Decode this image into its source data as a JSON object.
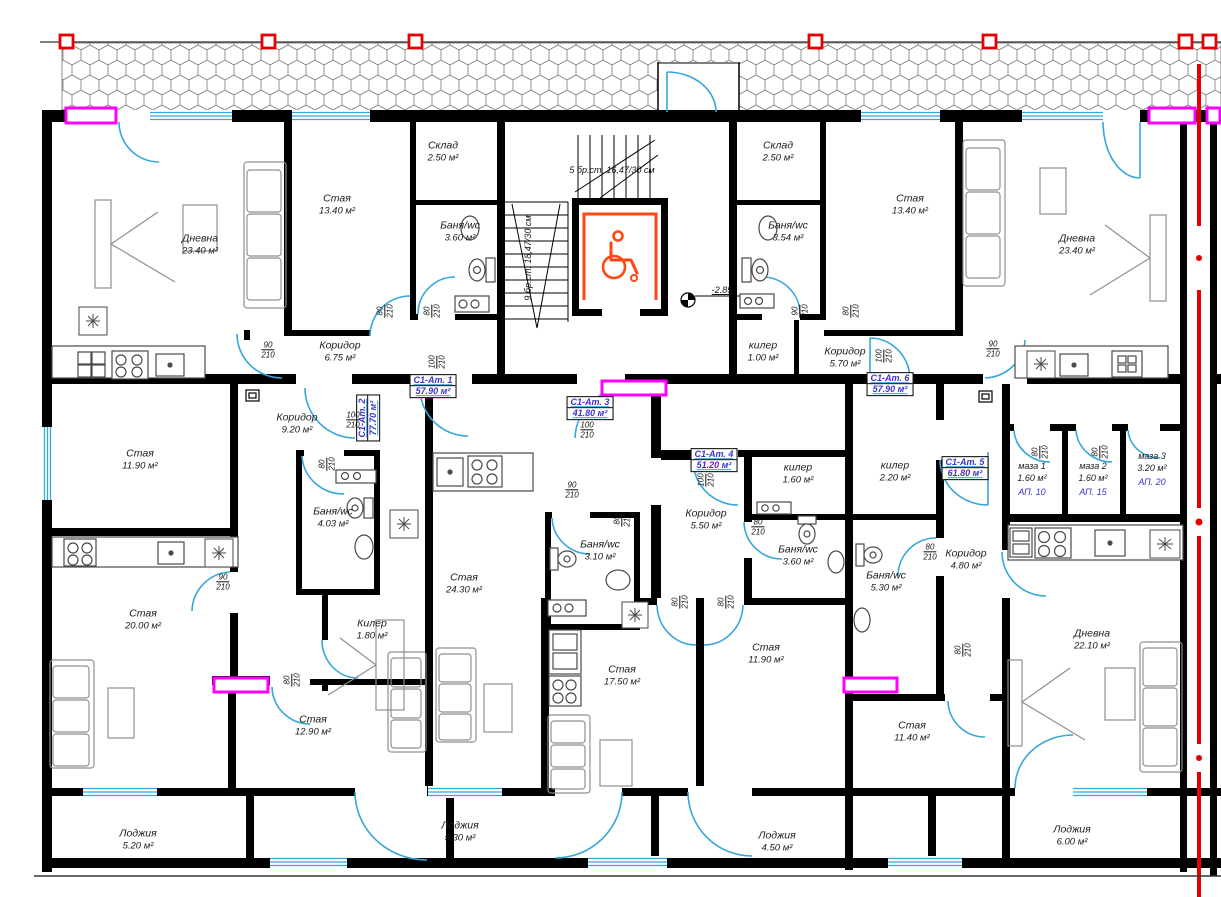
{
  "colors": {
    "wall": "#000000",
    "opening": "#35a7d9",
    "highlight": "#ff00ff",
    "datum": "#e60000",
    "accessible": "#ff4713",
    "apartment_text": "#3a35cc",
    "hatch": "#777777",
    "furniture": "#8f8f8f"
  },
  "rooms": [
    {
      "label": "Дневна",
      "area": "23.40 м²",
      "x": 200,
      "y": 245,
      "vertical": false
    },
    {
      "label": "Стая",
      "area": "13.40 м²",
      "x": 337,
      "y": 205,
      "vertical": false
    },
    {
      "label": "Склад",
      "area": "2.50 м²",
      "x": 443,
      "y": 152,
      "vertical": false
    },
    {
      "label": "Баня/wc",
      "area": "3.60 м²",
      "x": 460,
      "y": 232,
      "vertical": false
    },
    {
      "label": "Коридор",
      "area": "6.75 м²",
      "x": 340,
      "y": 352,
      "vertical": false
    },
    {
      "label": "Склад",
      "area": "2.50 м²",
      "x": 778,
      "y": 152,
      "vertical": false
    },
    {
      "label": "Баня/wc",
      "area": "3.54 м²",
      "x": 788,
      "y": 232,
      "vertical": false
    },
    {
      "label": "Стая",
      "area": "13.40 м²",
      "x": 910,
      "y": 205,
      "vertical": false
    },
    {
      "label": "Дневна",
      "area": "23.40 м²",
      "x": 1077,
      "y": 245,
      "vertical": false
    },
    {
      "label": "килер",
      "area": "1.00 м²",
      "x": 763,
      "y": 352,
      "vertical": false
    },
    {
      "label": "Коридор",
      "area": "5.70 м²",
      "x": 845,
      "y": 358,
      "vertical": false
    },
    {
      "label": "Стая",
      "area": "11.90 м²",
      "x": 140,
      "y": 460,
      "vertical": false
    },
    {
      "label": "Коридор",
      "area": "9.20 м²",
      "x": 297,
      "y": 424,
      "vertical": false
    },
    {
      "label": "Баня/wc",
      "area": "4.03 м²",
      "x": 333,
      "y": 518,
      "vertical": false
    },
    {
      "label": "Стая",
      "area": "20.00 м²",
      "x": 143,
      "y": 620,
      "vertical": false
    },
    {
      "label": "Килер",
      "area": "1.80 м²",
      "x": 372,
      "y": 630,
      "vertical": false
    },
    {
      "label": "Стая",
      "area": "12.90 м²",
      "x": 313,
      "y": 726,
      "vertical": false
    },
    {
      "label": "Лоджия",
      "area": "5.20 м²",
      "x": 138,
      "y": 840,
      "vertical": false
    },
    {
      "label": "Стая",
      "area": "24.30 м²",
      "x": 464,
      "y": 584,
      "vertical": false
    },
    {
      "label": "Баня/wc",
      "area": "3.10 м²",
      "x": 600,
      "y": 551,
      "vertical": false
    },
    {
      "label": "Стая",
      "area": "17.50 м²",
      "x": 622,
      "y": 676,
      "vertical": false
    },
    {
      "label": "Лоджия",
      "area": "5.30 м²",
      "x": 460,
      "y": 832,
      "vertical": false
    },
    {
      "label": "Коридор",
      "area": "5.50 м²",
      "x": 706,
      "y": 520,
      "vertical": false
    },
    {
      "label": "килер",
      "area": "1.60 м²",
      "x": 798,
      "y": 474,
      "vertical": false
    },
    {
      "label": "Баня/wc",
      "area": "3.60 м²",
      "x": 798,
      "y": 556,
      "vertical": false
    },
    {
      "label": "Стая",
      "area": "11.90 м²",
      "x": 766,
      "y": 654,
      "vertical": false
    },
    {
      "label": "Лоджия",
      "area": "4.50 м²",
      "x": 777,
      "y": 842,
      "vertical": false
    },
    {
      "label": "килер",
      "area": "2.20 м²",
      "x": 895,
      "y": 472,
      "vertical": false
    },
    {
      "label": "Баня/wc",
      "area": "5.30 м²",
      "x": 886,
      "y": 582,
      "vertical": false
    },
    {
      "label": "Коридор",
      "area": "4.80 м²",
      "x": 966,
      "y": 560,
      "vertical": false
    },
    {
      "label": "Стая",
      "area": "11.40 м²",
      "x": 912,
      "y": 732,
      "vertical": false
    },
    {
      "label": "Дневна",
      "area": "22.10 м²",
      "x": 1092,
      "y": 640,
      "vertical": false
    },
    {
      "label": "Лоджия",
      "area": "6.00 м²",
      "x": 1072,
      "y": 836,
      "vertical": false
    }
  ],
  "apartments": [
    {
      "id": "С1-Ат. 1",
      "area": "57.90 м²",
      "x": 433,
      "y": 386,
      "vertical": false
    },
    {
      "id": "С1-Ат. 2",
      "area": "77.70 м²",
      "x": 368,
      "y": 418,
      "vertical": true
    },
    {
      "id": "С1-Ат. 3",
      "area": "41.80 м²",
      "x": 590,
      "y": 408,
      "vertical": false
    },
    {
      "id": "С1-Ат. 4",
      "area": "51.20 м²",
      "x": 714,
      "y": 460,
      "vertical": false
    },
    {
      "id": "С1-Ат. 5",
      "area": "61.80 м²",
      "x": 965,
      "y": 468,
      "vertical": false
    },
    {
      "id": "С1-Ат. 6",
      "area": "57.90 м²",
      "x": 890,
      "y": 384,
      "vertical": false
    }
  ],
  "cellars": [
    {
      "label": "маза 1",
      "area": "1.60 м²",
      "apt": "АП. 10",
      "x": 1032,
      "y": 480
    },
    {
      "label": "маза 2",
      "area": "1.60 м²",
      "apt": "АП. 15",
      "x": 1093,
      "y": 480
    },
    {
      "label": "маза 3",
      "area": "3.20 м²",
      "apt": "АП. 20",
      "x": 1152,
      "y": 470
    }
  ],
  "door_labels": [
    {
      "size": "90/210",
      "x": 268,
      "y": 350,
      "vertical": false
    },
    {
      "size": "80/210",
      "x": 385,
      "y": 311,
      "vertical": true
    },
    {
      "size": "80/210",
      "x": 432,
      "y": 311,
      "vertical": true
    },
    {
      "size": "100/210",
      "x": 437,
      "y": 362,
      "vertical": true
    },
    {
      "size": "90/210",
      "x": 800,
      "y": 311,
      "vertical": true
    },
    {
      "size": "80/210",
      "x": 851,
      "y": 311,
      "vertical": true
    },
    {
      "size": "100/210",
      "x": 884,
      "y": 356,
      "vertical": true
    },
    {
      "size": "100/210",
      "x": 353,
      "y": 420,
      "vertical": false
    },
    {
      "size": "80/210",
      "x": 327,
      "y": 464,
      "vertical": true
    },
    {
      "size": "90/210",
      "x": 223,
      "y": 582,
      "vertical": false
    },
    {
      "size": "80/210",
      "x": 292,
      "y": 680,
      "vertical": true
    },
    {
      "size": "100/210",
      "x": 587,
      "y": 430,
      "vertical": false
    },
    {
      "size": "90/210",
      "x": 572,
      "y": 490,
      "vertical": false
    },
    {
      "size": "80/210",
      "x": 622,
      "y": 520,
      "vertical": true
    },
    {
      "size": "100/210",
      "x": 706,
      "y": 480,
      "vertical": true
    },
    {
      "size": "80/210",
      "x": 680,
      "y": 602,
      "vertical": true
    },
    {
      "size": "80/210",
      "x": 726,
      "y": 602,
      "vertical": true
    },
    {
      "size": "80/210",
      "x": 758,
      "y": 527,
      "vertical": false
    },
    {
      "size": "80/210",
      "x": 930,
      "y": 552,
      "vertical": false
    },
    {
      "size": "90/210",
      "x": 993,
      "y": 349,
      "vertical": false
    },
    {
      "size": "80/210",
      "x": 1040,
      "y": 452,
      "vertical": true
    },
    {
      "size": "80/210",
      "x": 1100,
      "y": 452,
      "vertical": true
    },
    {
      "size": "80/210",
      "x": 963,
      "y": 650,
      "vertical": true
    }
  ],
  "annotations": [
    {
      "text": "5 бр.ст. 16,47/30 см",
      "x": 612,
      "y": 170,
      "vertical": false,
      "cls": ""
    },
    {
      "text": "9 бр.ст. 18,47/30 см",
      "x": 528,
      "y": 258,
      "vertical": true,
      "cls": ""
    },
    {
      "text": "-2.85",
      "x": 722,
      "y": 290,
      "vertical": false,
      "cls": "level"
    }
  ]
}
